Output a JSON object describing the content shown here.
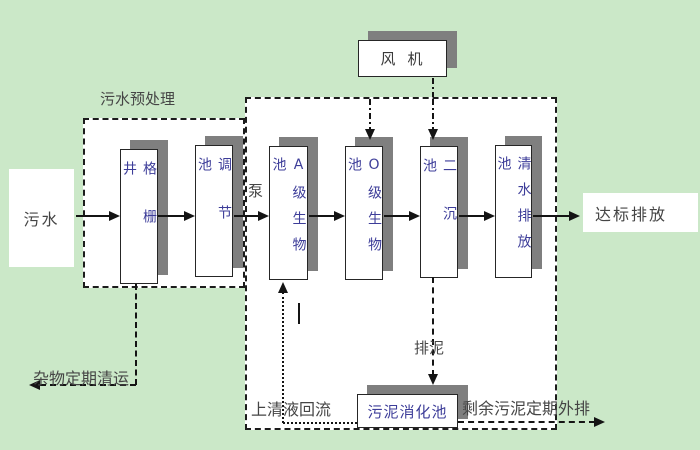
{
  "diagram_title": "wastewater-treatment-process-flow",
  "colors": {
    "background": "#cbe8c8",
    "box_fill": "#ffffff",
    "box_border": "#262626",
    "box_shadow": "#7f7f7f",
    "box_text": "#3d3d99",
    "label_text": "#454545",
    "line": "#141414"
  },
  "nodes": {
    "sewage": {
      "label": "污水"
    },
    "grille_well": {
      "label": "格栅井"
    },
    "regulating_tank": {
      "label": "调节池"
    },
    "tank_a": {
      "label": "A级生物池"
    },
    "tank_o": {
      "label": "O级生物池"
    },
    "secondary_sedimentation": {
      "label": "二沉池"
    },
    "clean_water_tank": {
      "label": "清水排放池"
    },
    "fan": {
      "label": "风机"
    },
    "sludge_digestion": {
      "label": "污泥消化池"
    },
    "discharge": {
      "label": "达标排放"
    }
  },
  "annotations": {
    "pretreatment": {
      "label": "污水预处理"
    },
    "pump": {
      "label": "泵"
    },
    "debris_removal": {
      "label": "杂物定期清运"
    },
    "supernatant_return": {
      "label": "上清液回流"
    },
    "sludge_out": {
      "label": "排泥"
    },
    "excess_sludge_out": {
      "label": "剩余污泥定期外排"
    }
  }
}
